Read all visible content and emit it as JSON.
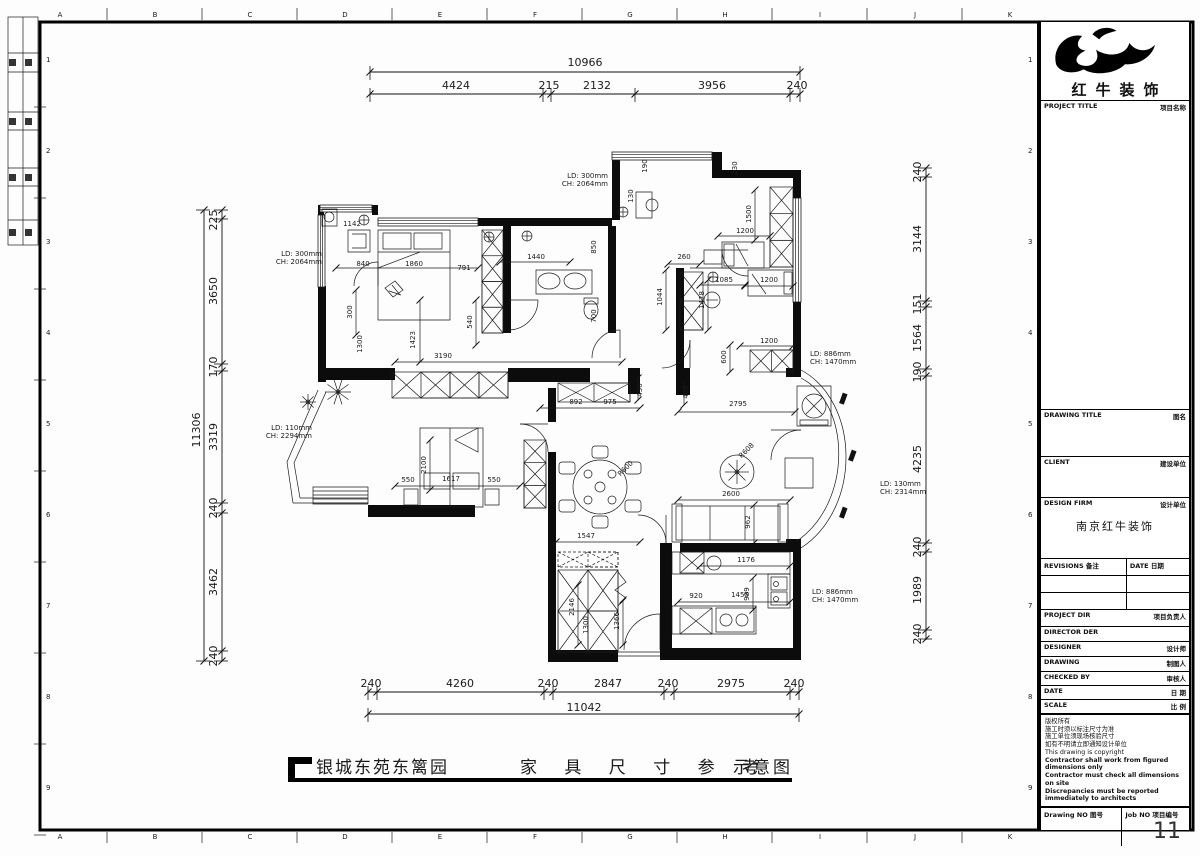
{
  "frame": {
    "letters": [
      "A",
      "B",
      "C",
      "D",
      "E",
      "F",
      "G",
      "H",
      "I",
      "J",
      "K"
    ],
    "numbers": [
      "1",
      "2",
      "3",
      "4",
      "5",
      "6",
      "7",
      "8",
      "9"
    ]
  },
  "titleblock": {
    "brand": "红牛装饰",
    "rows": [
      {
        "en": "PROJECT TITLE",
        "cn": "项目名称"
      },
      {
        "en": "DRAWING TITLE",
        "cn": "图名"
      },
      {
        "en": "CLIENT",
        "cn": "建设单位"
      },
      {
        "en": "DESIGN FIRM",
        "cn": "设计单位"
      },
      {
        "en": "REVISIONS",
        "cn": "备注"
      },
      {
        "en": "PROJECT DIR",
        "cn": "项目负责人"
      },
      {
        "en": "DIRECTOR DER",
        "cn": ""
      },
      {
        "en": "DESIGNER",
        "cn": "设计师"
      },
      {
        "en": "DRAWING",
        "cn": "制图人"
      },
      {
        "en": "CHECKED BY",
        "cn": "审核人"
      },
      {
        "en": "DATE",
        "cn": "日 期"
      },
      {
        "en": "SCALE",
        "cn": "比 例"
      }
    ],
    "date_col": {
      "en": "DATE",
      "cn": "日期"
    },
    "firm": "南京红牛装饰",
    "notes": [
      "版权所有",
      "施工时须以标注尺寸为准",
      "施工单位须现场核验尺寸",
      "如有不明请立即通知设计单位",
      "This drawing is copyright",
      "Contractor shall work from figured dimensions only",
      "Contractor must check all dimensions on site",
      "Discrepancies must be reported immediately to architects"
    ],
    "drawing_no_label": "Drawing NO 图号",
    "job_no_label": "Job NO 项目编号",
    "job_no": "11"
  },
  "footer": {
    "project": "银城东苑东篱园",
    "title": "家 具 尺 寸 参 考",
    "suffix": "示意图"
  },
  "plan": {
    "texts": [
      {
        "t": "10966",
        "x": 585,
        "y": 66,
        "fs": 11
      },
      {
        "t": "4424",
        "x": 456,
        "y": 89,
        "fs": 11
      },
      {
        "t": "215",
        "x": 549,
        "y": 89,
        "fs": 11
      },
      {
        "t": "2132",
        "x": 597,
        "y": 89,
        "fs": 11
      },
      {
        "t": "3956",
        "x": 712,
        "y": 89,
        "fs": 11
      },
      {
        "t": "240",
        "x": 797,
        "y": 89,
        "fs": 11
      },
      {
        "t": "11042",
        "x": 584,
        "y": 711,
        "fs": 11
      },
      {
        "t": "240",
        "x": 371,
        "y": 687,
        "fs": 11
      },
      {
        "t": "4260",
        "x": 460,
        "y": 687,
        "fs": 11
      },
      {
        "t": "240",
        "x": 548,
        "y": 687,
        "fs": 11
      },
      {
        "t": "2847",
        "x": 608,
        "y": 687,
        "fs": 11
      },
      {
        "t": "240",
        "x": 668,
        "y": 687,
        "fs": 11
      },
      {
        "t": "2975",
        "x": 731,
        "y": 687,
        "fs": 11
      },
      {
        "t": "240",
        "x": 794,
        "y": 687,
        "fs": 11
      },
      {
        "t": "225",
        "x": 217,
        "y": 220,
        "r": -90,
        "fs": 11
      },
      {
        "t": "3650",
        "x": 217,
        "y": 291,
        "r": -90,
        "fs": 11
      },
      {
        "t": "170",
        "x": 217,
        "y": 367,
        "r": -90,
        "fs": 11
      },
      {
        "t": "3319",
        "x": 217,
        "y": 437,
        "r": -90,
        "fs": 11
      },
      {
        "t": "240",
        "x": 217,
        "y": 508,
        "r": -90,
        "fs": 11
      },
      {
        "t": "3462",
        "x": 217,
        "y": 582,
        "r": -90,
        "fs": 11
      },
      {
        "t": "240",
        "x": 217,
        "y": 656,
        "r": -90,
        "fs": 11
      },
      {
        "t": "11306",
        "x": 200,
        "y": 430,
        "r": -90,
        "fs": 11
      },
      {
        "t": "240",
        "x": 921,
        "y": 172,
        "r": -90,
        "fs": 11
      },
      {
        "t": "3144",
        "x": 921,
        "y": 239,
        "r": -90,
        "fs": 11
      },
      {
        "t": "151",
        "x": 921,
        "y": 304,
        "r": -90,
        "fs": 11
      },
      {
        "t": "1564",
        "x": 921,
        "y": 338,
        "r": -90,
        "fs": 11
      },
      {
        "t": "190",
        "x": 921,
        "y": 372,
        "r": -90,
        "fs": 11
      },
      {
        "t": "4235",
        "x": 921,
        "y": 459,
        "r": -90,
        "fs": 11
      },
      {
        "t": "240",
        "x": 921,
        "y": 547,
        "r": -90,
        "fs": 11
      },
      {
        "t": "1989",
        "x": 921,
        "y": 590,
        "r": -90,
        "fs": 11
      },
      {
        "t": "240",
        "x": 921,
        "y": 634,
        "r": -90,
        "fs": 11
      },
      {
        "t": "LD: 300mm",
        "x": 322,
        "y": 256,
        "a": "e"
      },
      {
        "t": "CH: 2064mm",
        "x": 322,
        "y": 264,
        "a": "e"
      },
      {
        "t": "LD: 300mm",
        "x": 608,
        "y": 178,
        "a": "e"
      },
      {
        "t": "CH: 2064mm",
        "x": 608,
        "y": 186,
        "a": "e"
      },
      {
        "t": "LD: 110mm",
        "x": 312,
        "y": 430,
        "a": "e"
      },
      {
        "t": "CH: 2294mm",
        "x": 312,
        "y": 438,
        "a": "e"
      },
      {
        "t": "LD: 886mm",
        "x": 810,
        "y": 356,
        "a": "s"
      },
      {
        "t": "CH: 1470mm",
        "x": 810,
        "y": 364,
        "a": "s"
      },
      {
        "t": "LD: 130mm",
        "x": 880,
        "y": 486,
        "a": "s"
      },
      {
        "t": "CH: 2314mm",
        "x": 880,
        "y": 494,
        "a": "s"
      },
      {
        "t": "LD: 886mm",
        "x": 812,
        "y": 594,
        "a": "s"
      },
      {
        "t": "CH: 1470mm",
        "x": 812,
        "y": 602,
        "a": "s"
      },
      {
        "t": "1142",
        "x": 352,
        "y": 226
      },
      {
        "t": "840",
        "x": 363,
        "y": 266
      },
      {
        "t": "1860",
        "x": 414,
        "y": 266
      },
      {
        "t": "791",
        "x": 464,
        "y": 270
      },
      {
        "t": "1440",
        "x": 536,
        "y": 259
      },
      {
        "t": "540",
        "x": 472,
        "y": 322,
        "r": -90
      },
      {
        "t": "300",
        "x": 352,
        "y": 312,
        "r": -90
      },
      {
        "t": "1300",
        "x": 362,
        "y": 344,
        "r": -90
      },
      {
        "t": "1423",
        "x": 415,
        "y": 340,
        "r": -90
      },
      {
        "t": "3190",
        "x": 443,
        "y": 358
      },
      {
        "t": "190",
        "x": 647,
        "y": 166,
        "r": -90
      },
      {
        "t": "130",
        "x": 633,
        "y": 196,
        "r": -90
      },
      {
        "t": "230",
        "x": 737,
        "y": 168,
        "r": -90
      },
      {
        "t": "1500",
        "x": 751,
        "y": 214,
        "r": -90
      },
      {
        "t": "1200",
        "x": 745,
        "y": 233
      },
      {
        "t": "850",
        "x": 596,
        "y": 247,
        "r": -90
      },
      {
        "t": "700",
        "x": 596,
        "y": 316,
        "r": -90
      },
      {
        "t": "260",
        "x": 684,
        "y": 259
      },
      {
        "t": "1044",
        "x": 662,
        "y": 297,
        "r": -90
      },
      {
        "t": "1085",
        "x": 724,
        "y": 282
      },
      {
        "t": "1478",
        "x": 704,
        "y": 300,
        "r": -90
      },
      {
        "t": "1200",
        "x": 769,
        "y": 282
      },
      {
        "t": "1200",
        "x": 769,
        "y": 343
      },
      {
        "t": "600",
        "x": 726,
        "y": 357,
        "r": -90
      },
      {
        "t": "892",
        "x": 576,
        "y": 404
      },
      {
        "t": "975",
        "x": 610,
        "y": 404
      },
      {
        "t": "450",
        "x": 642,
        "y": 390,
        "r": -90
      },
      {
        "t": "400",
        "x": 688,
        "y": 392,
        "r": -90
      },
      {
        "t": "2795",
        "x": 738,
        "y": 406
      },
      {
        "t": "R608",
        "x": 748,
        "y": 452,
        "r": -45
      },
      {
        "t": "R600",
        "x": 627,
        "y": 470,
        "r": -45
      },
      {
        "t": "2600",
        "x": 731,
        "y": 496
      },
      {
        "t": "962",
        "x": 750,
        "y": 522,
        "r": -90
      },
      {
        "t": "550",
        "x": 408,
        "y": 482
      },
      {
        "t": "1617",
        "x": 451,
        "y": 481
      },
      {
        "t": "550",
        "x": 494,
        "y": 482
      },
      {
        "t": "2100",
        "x": 426,
        "y": 465,
        "r": -90
      },
      {
        "t": "1547",
        "x": 586,
        "y": 538
      },
      {
        "t": "2146",
        "x": 574,
        "y": 607,
        "r": -90
      },
      {
        "t": "1300",
        "x": 588,
        "y": 625,
        "r": -90
      },
      {
        "t": "1366",
        "x": 619,
        "y": 621,
        "r": -90
      },
      {
        "t": "1176",
        "x": 746,
        "y": 562
      },
      {
        "t": "920",
        "x": 696,
        "y": 598
      },
      {
        "t": "1455",
        "x": 740,
        "y": 597
      },
      {
        "t": "989",
        "x": 749,
        "y": 594,
        "r": -90
      }
    ]
  }
}
